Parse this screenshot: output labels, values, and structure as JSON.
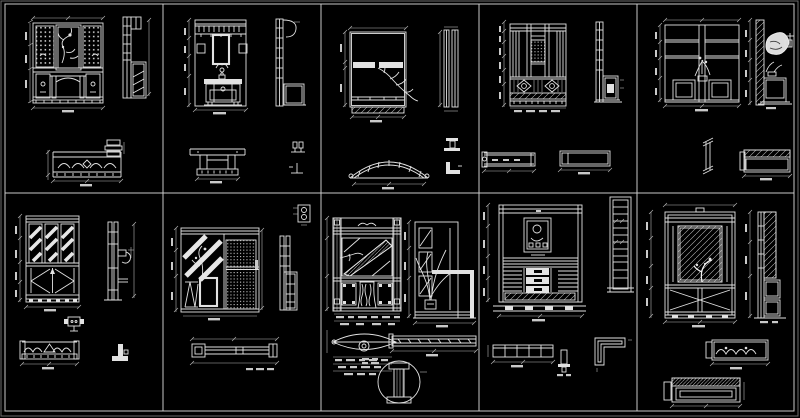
{
  "sheet": {
    "background_color": "#000000",
    "line_color": "#e2e2e2",
    "grid_color": "#c9c9c9",
    "rows": 2,
    "columns": 5,
    "description": "CAD sheet of ten Chinese-style entry cabinet drawings, each cell with front elevation, side section and plan views with dimension lines"
  },
  "panels": [
    {
      "id": 1,
      "name": "lattice-altar-cabinet",
      "views": [
        "front-elevation",
        "side-section",
        "plan-view",
        "edge-detail"
      ]
    },
    {
      "id": 2,
      "name": "coat-hook-console",
      "views": [
        "front-elevation",
        "side-section",
        "plan-view",
        "fitting-details"
      ]
    },
    {
      "id": 3,
      "name": "branch-decor-panel",
      "views": [
        "front-elevation",
        "side-strips",
        "curved-plan-view",
        "strip-details"
      ]
    },
    {
      "id": 4,
      "name": "carved-screen-cabinet",
      "views": [
        "front-elevation",
        "side-section",
        "plan-views"
      ]
    },
    {
      "id": 5,
      "name": "plant-display-shelf",
      "views": [
        "front-elevation",
        "hatched-wall-section",
        "baluster-detail",
        "plan-view"
      ]
    },
    {
      "id": 6,
      "name": "striped-door-cabinet",
      "views": [
        "front-elevation",
        "side-section",
        "outlet-detail",
        "plan-view",
        "corner-detail"
      ]
    },
    {
      "id": 7,
      "name": "mirror-peg-partition",
      "views": [
        "front-elevation",
        "side-section",
        "knob-detail",
        "plan-view"
      ]
    },
    {
      "id": 8,
      "name": "hall-cabinet-pair",
      "views": [
        "left-elevation",
        "right-elevation",
        "leaf-plan",
        "plan-strip",
        "section-detail-circle"
      ]
    },
    {
      "id": 9,
      "name": "drawer-chest-art-niche",
      "views": [
        "front-elevation",
        "side-section",
        "plan-view",
        "pedestal-detail",
        "corner-plan-detail"
      ]
    },
    {
      "id": 10,
      "name": "mirror-hall-cabinet",
      "views": [
        "front-elevation",
        "side-section",
        "scroll-plan",
        "hatched-plan"
      ]
    }
  ]
}
